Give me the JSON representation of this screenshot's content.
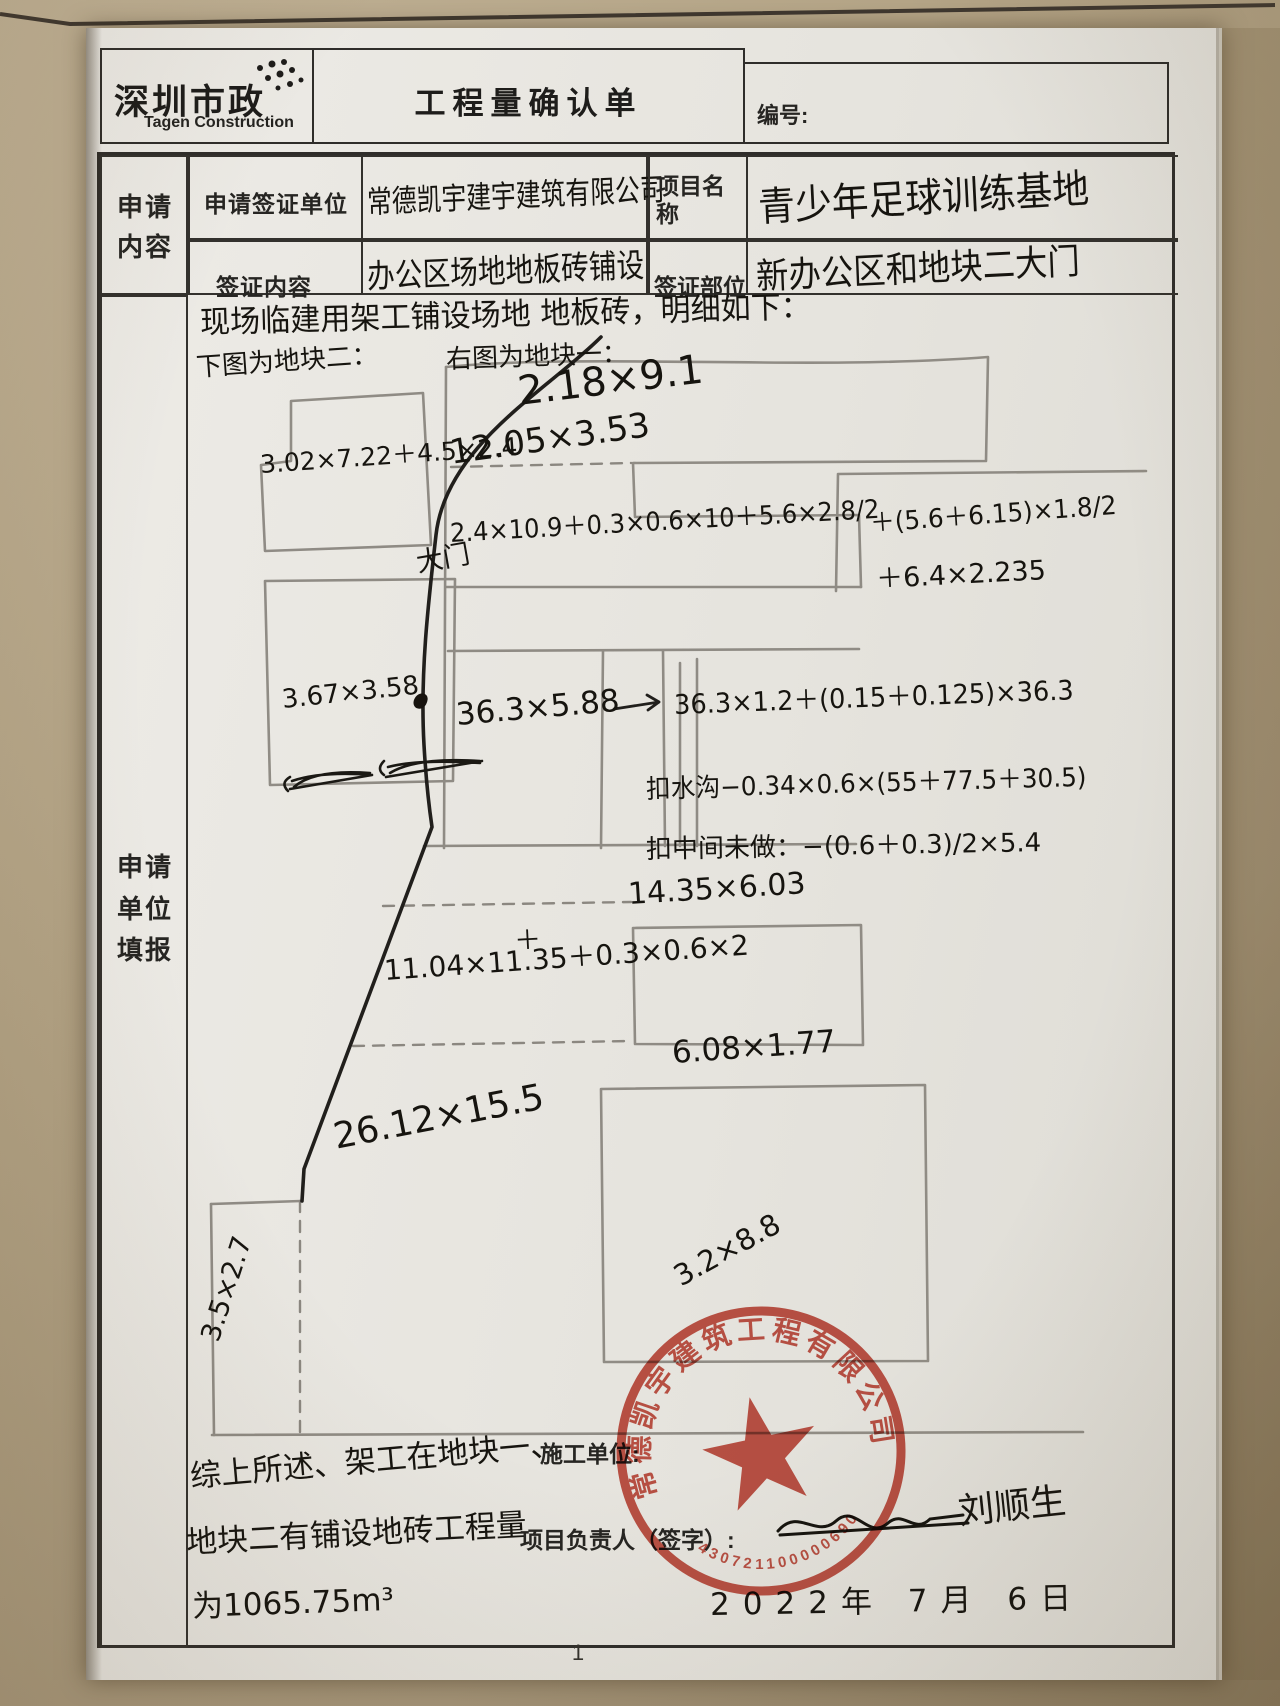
{
  "header": {
    "logo_cn": "深圳市政",
    "logo_en": "Tagen Construction",
    "title": "工程量确认单",
    "number_label": "编号:"
  },
  "form": {
    "left_group_top": "申请内容",
    "row1_label": "申请签证单位",
    "row1_value": "常德凯宇建宇建筑有限公司",
    "row1_label2": "项目名称",
    "row1_value2": "青少年足球训练基地",
    "row2_label": "签证内容",
    "row2_value": "办公区场地地板砖铺设",
    "row2_label2": "签证部位",
    "row2_value2": "新办公区和地块二大门",
    "left_group_main": "申请单位填报"
  },
  "sketch": {
    "intro": "现场临建用架工铺设场地 地板砖，明细如下：",
    "left_caption": "下图为地块二：",
    "right_caption": "右图为地块一：",
    "block2_area1": "3.02×7.22＋4.5×2.4",
    "gate": "大门",
    "block2_area2": "3.67×3.58",
    "area_top": "2.18×9.1",
    "area_r2": "12.05×3.53",
    "formula1": "2.4×10.9＋0.3×0.6×10＋5.6×2.8/2",
    "formula2": "＋(5.6＋6.15)×1.8/2",
    "formula3": "＋6.4×2.235",
    "arrow_note": "36.3×1.2＋(0.15＋0.125)×36.3",
    "area_r3": "36.3×5.88",
    "deduct1": "扣水沟−0.34×0.6×(55＋77.5＋30.5)",
    "deduct2": "扣中间未做：−(0.6＋0.3)/2×5.4",
    "area_r4": "14.35×6.03",
    "area_r5": "11.04×11.35＋0.3×0.6×2",
    "insert_mark": "＋",
    "area_r6": "6.08×1.77",
    "area_r7": "26.12×15.5",
    "area_r8": "3.5×2.7",
    "area_r9": "3.2×8.8",
    "summary1": "综上所述、架工在地块一、",
    "summary2": "地块二有铺设地砖工程量",
    "summary3": "为1065.75m³"
  },
  "footer": {
    "builder_label": "施工单位:",
    "manager_label": "项目负责人（签字）:",
    "signature": "刘顺生",
    "date": "2022年 7月 6日",
    "stamp_company": "常德凯宇建筑工程有限公司",
    "stamp_number": "430721100000690",
    "page_number": "1"
  },
  "colors": {
    "stamp_red": "#c13a2c",
    "ink": "#16140f",
    "pencil": "#8b8780"
  }
}
